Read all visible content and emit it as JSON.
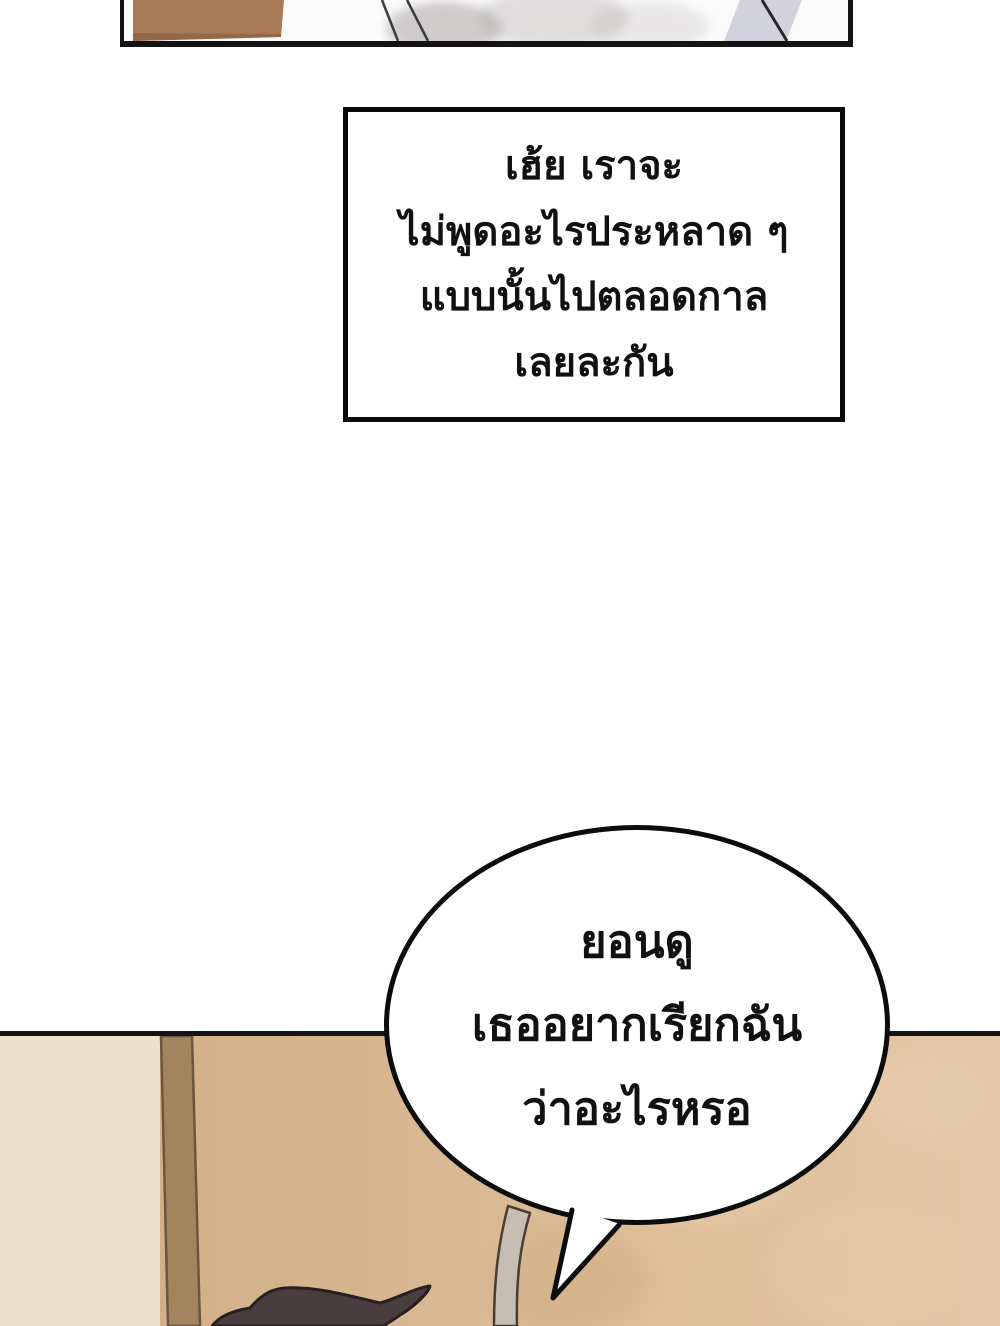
{
  "dialog_box": {
    "lines": [
      "เฮ้ย เราจะ",
      "ไม่พูดอะไรประหลาด ๆ",
      "แบบนั้นไปตลอดกาล",
      "เลยละกัน"
    ]
  },
  "speech_bubble": {
    "lines": [
      "ยอนดู",
      "เธออยากเรียกฉัน",
      "ว่าอะไรหรอ"
    ]
  },
  "colors": {
    "panel_border": "#131313",
    "text_color": "#111111",
    "bubble_fill": "#ffffff",
    "floor_tan": "#d9ba92",
    "wall_cream": "#ece1cc",
    "pole_brown": "#a2855e",
    "strap_gray": "#c6bdb3",
    "hair_dark": "#493d40",
    "top_panel_brown": "#a87a58",
    "top_panel_bluegray": "#d2d2dc"
  }
}
